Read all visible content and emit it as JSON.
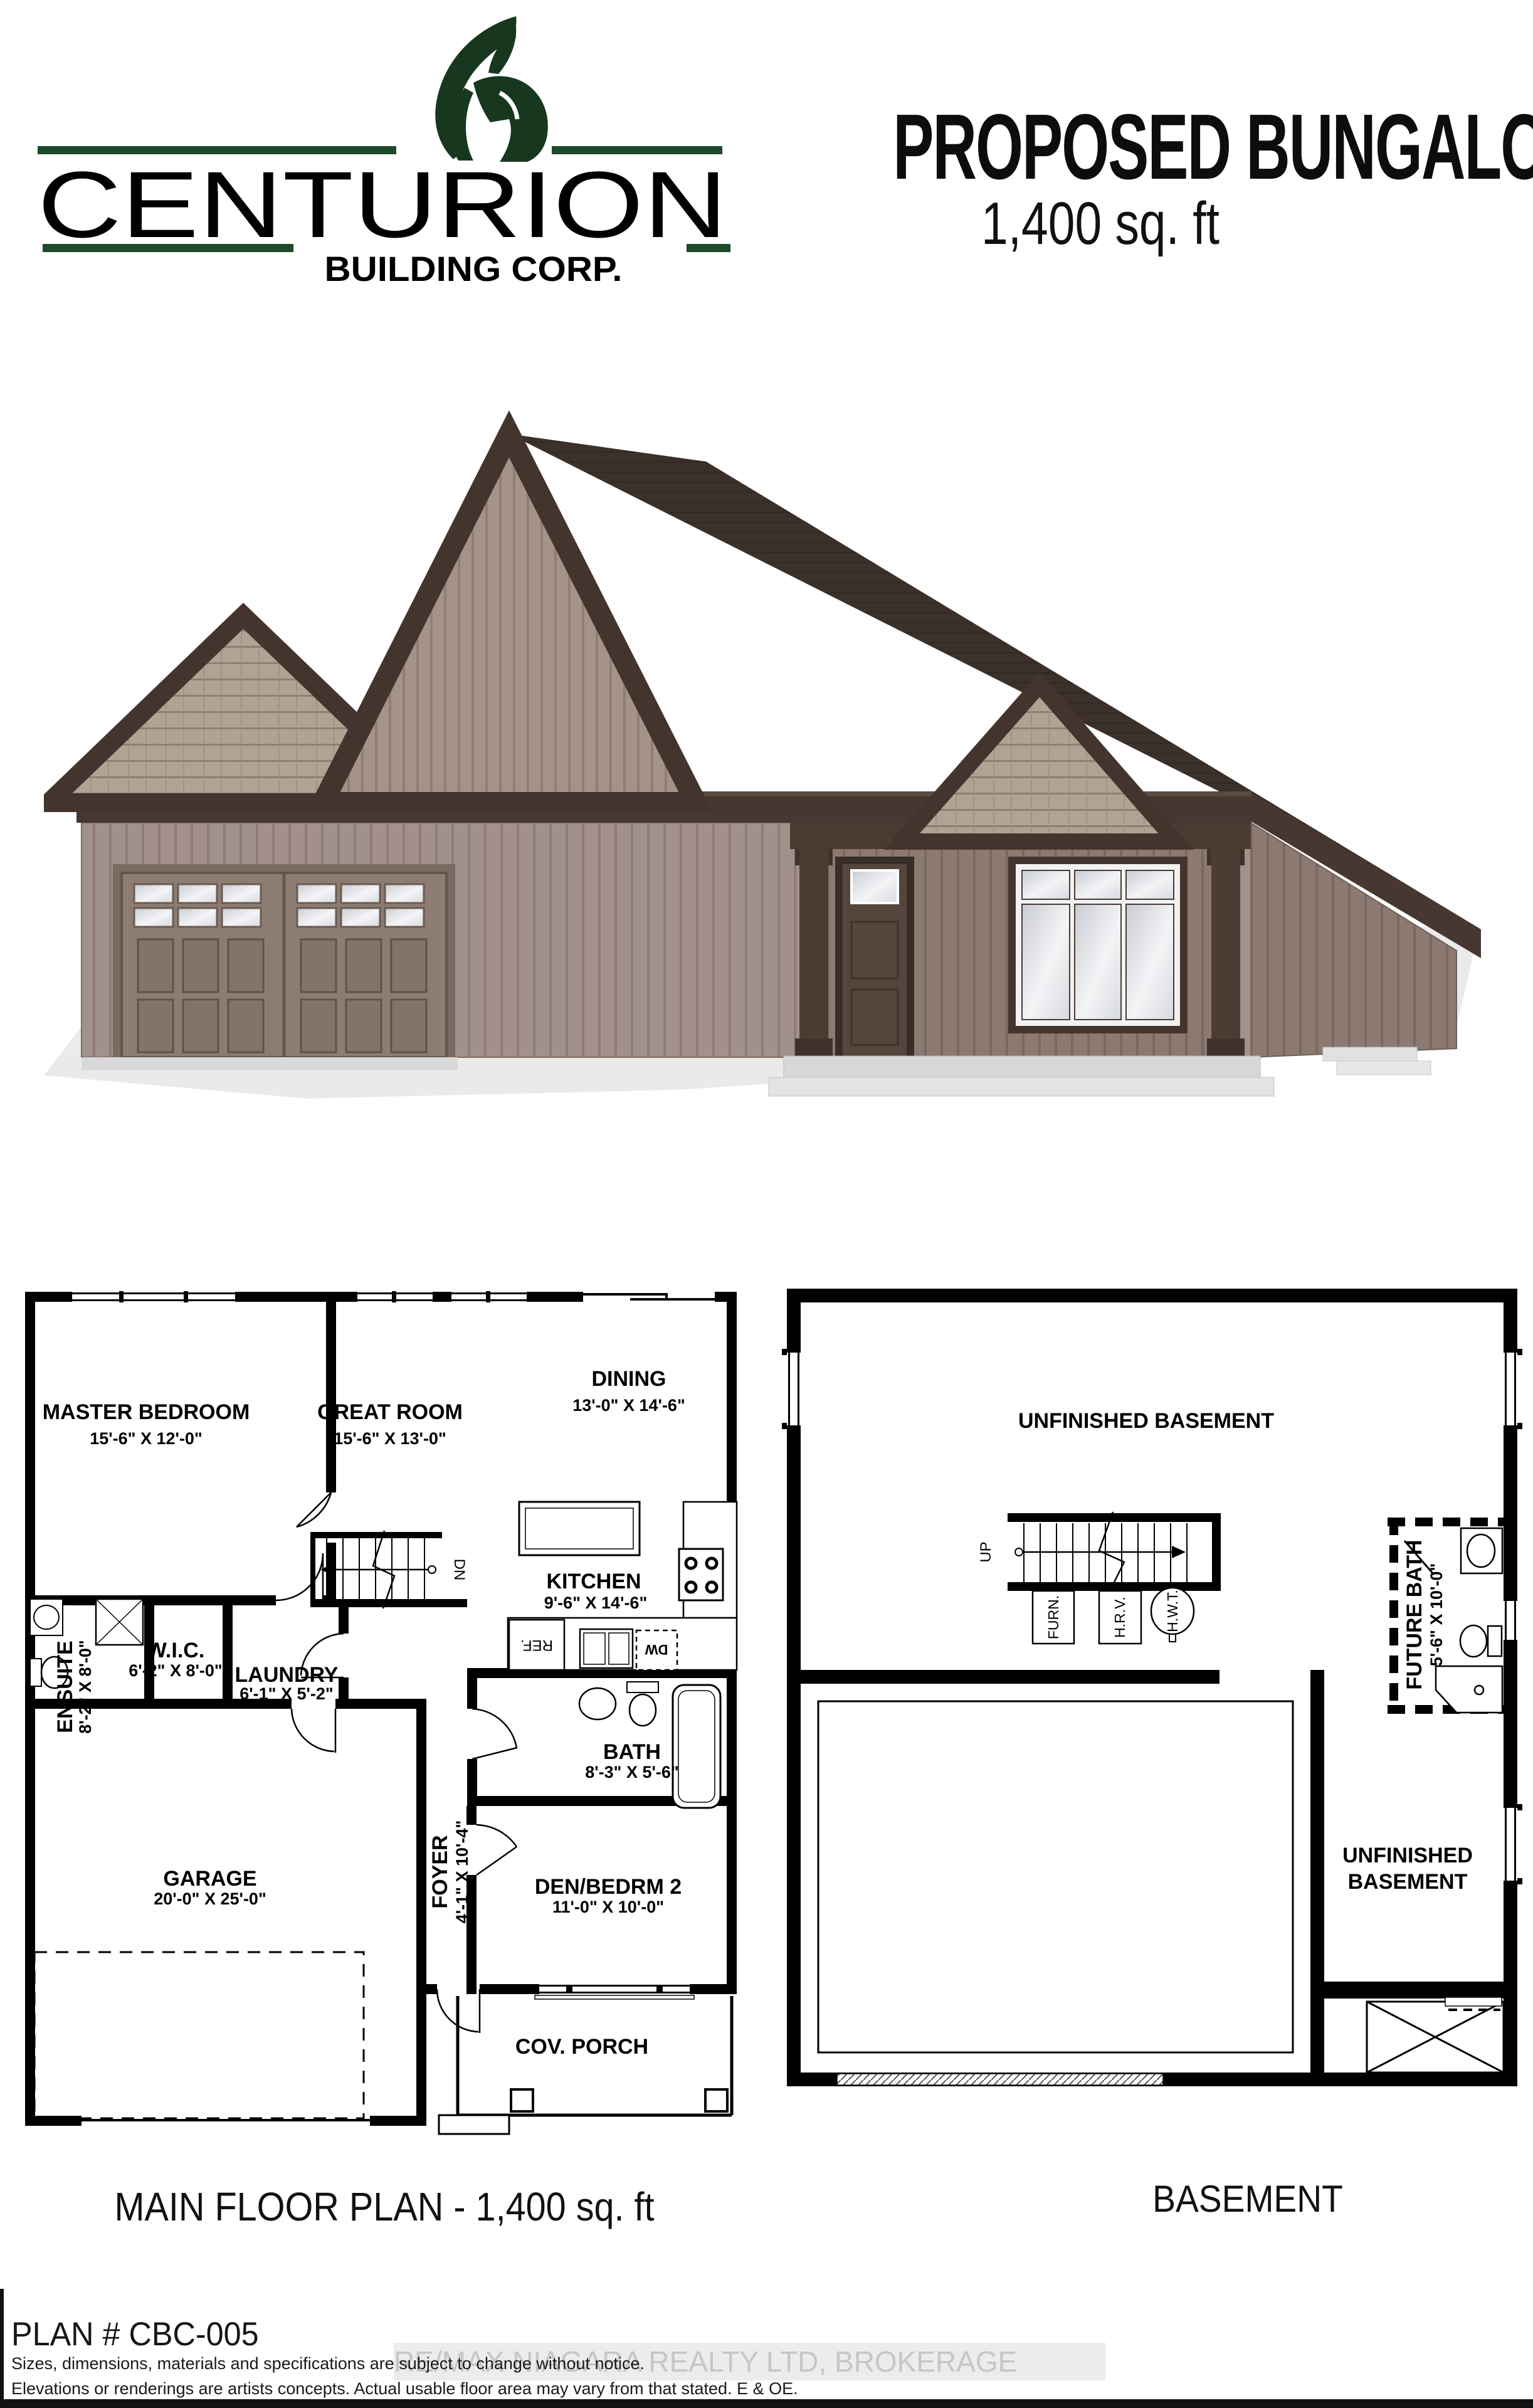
{
  "logo": {
    "brand": "CENTURION",
    "tagline": "BUILDING CORP.",
    "helmet_icon": "spartan-helmet"
  },
  "header": {
    "title": "PROPOSED BUNGALOW",
    "subtitle": "1,400 sq. ft"
  },
  "main_floor": {
    "caption": "MAIN FLOOR PLAN - 1,400 sq. ft",
    "rooms": {
      "master": {
        "name": "MASTER BEDROOM",
        "dims": "15'-6\" X 12'-0\""
      },
      "great": {
        "name": "GREAT ROOM",
        "dims": "15'-6\" X 13'-0\""
      },
      "dining": {
        "name": "DINING",
        "dims": "13'-0\" X 14'-6\""
      },
      "kitchen": {
        "name": "KITCHEN",
        "dims": "9'-6\" X 14'-6\""
      },
      "ensuite": {
        "name": "ENSUITE",
        "dims": "8'-2\" X 8'-0\""
      },
      "wic": {
        "name": "W.I.C.",
        "dims": "6'-2\" X 8'-0\""
      },
      "laundry": {
        "name": "LAUNDRY",
        "dims": "6'-1\" X 5'-2\""
      },
      "bath": {
        "name": "BATH",
        "dims": "8'-3\" X 5'-6\""
      },
      "foyer": {
        "name": "FOYER",
        "dims": "4'-1\" X 10'-4\""
      },
      "den": {
        "name": "DEN/BEDRM 2",
        "dims": "11'-0\" X 10'-0\""
      },
      "garage": {
        "name": "GARAGE",
        "dims": "20'-0\" X 25'-0\""
      },
      "porch": {
        "name": "COV. PORCH"
      }
    },
    "labels": {
      "dn": "DN",
      "ref": "REF.",
      "dw": "DW"
    }
  },
  "basement": {
    "caption": "BASEMENT",
    "rooms": {
      "unfinished_top": "UNFINISHED BASEMENT",
      "unfinished_bottom_line1": "UNFINISHED",
      "unfinished_bottom_line2": "BASEMENT",
      "future_bath": {
        "name": "FUTURE BATH",
        "dims": "5'-6\" X 10'-0\""
      }
    },
    "labels": {
      "up": "UP",
      "furn": "FURN.",
      "hrv": "H.R.V.",
      "hwt": "H.W.T."
    }
  },
  "footer": {
    "plan_number": "PLAN # CBC-005",
    "disclaimer_line1": "Sizes, dimensions, materials and specifications are subject to change without notice.",
    "disclaimer_line2": "Elevations or renderings are artists concepts. Actual usable floor area may vary from that stated. E & OE.",
    "watermark": "RE/MAX NIAGARA REALTY LTD, BROKERAGE"
  },
  "colors": {
    "plan_ink": "#000000",
    "dw_accent": "#e8336d",
    "logo_green": "#1d4a2a",
    "logo_gray": "#8e8e8e",
    "watermark_gray": "#c6c6c6",
    "roof_brown": "#3c302a",
    "siding_taupe": "#a2908a",
    "trim_brown": "#463830"
  }
}
